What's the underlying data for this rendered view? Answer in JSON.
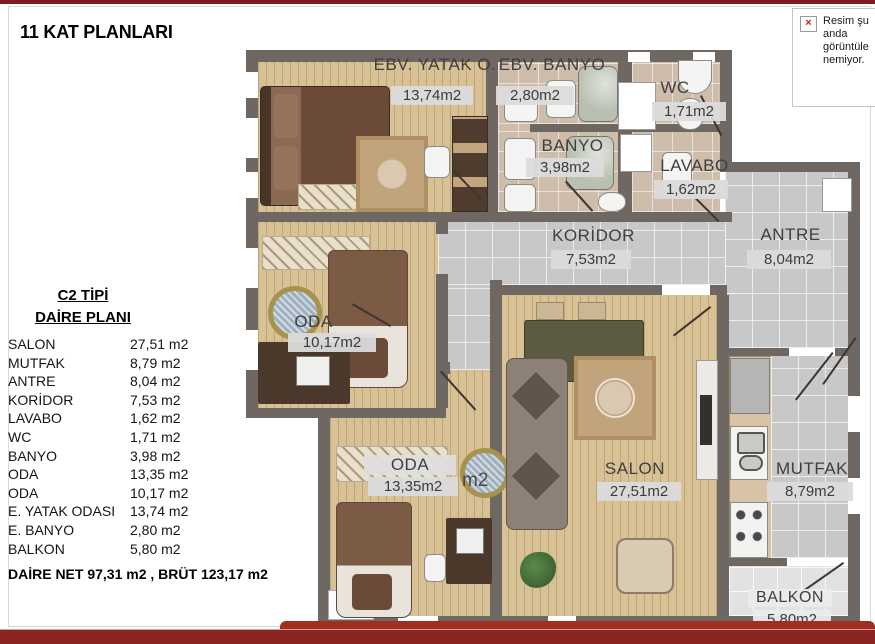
{
  "page": {
    "title": "11 KAT PLANLARI",
    "top_bar_color": "#7d1e1e",
    "bottom_bar_color": "#8b2521"
  },
  "broken_image_notice": {
    "icon": "broken-image-x-icon",
    "text": "Resim şu anda görüntüle nemiyor."
  },
  "legend": {
    "title_line1": "C2 TİPİ",
    "title_line2": "DAİRE PLANI",
    "items": [
      {
        "name": "SALON",
        "area": "27,51 m2"
      },
      {
        "name": "MUTFAK",
        "area": "8,79 m2"
      },
      {
        "name": "ANTRE",
        "area": "8,04 m2"
      },
      {
        "name": "KORİDOR",
        "area": "7,53 m2"
      },
      {
        "name": "LAVABO",
        "area": "1,62 m2"
      },
      {
        "name": "WC",
        "area": "1,71 m2"
      },
      {
        "name": "BANYO",
        "area": "3,98 m2"
      },
      {
        "name": "ODA",
        "area": "13,35 m2"
      },
      {
        "name": "ODA",
        "area": "10,17 m2"
      },
      {
        "name": "E. YATAK ODASI",
        "area": "13,74 m2"
      },
      {
        "name": "E. BANYO",
        "area": "2,80 m2"
      },
      {
        "name": "BALKON",
        "area": "5,80 m2"
      }
    ],
    "summary": "DAİRE NET 97,31 m2 , BRÜT 123,17 m2"
  },
  "plan": {
    "rooms": [
      {
        "name": "EBV. YATAK O.",
        "area": "13,74m2"
      },
      {
        "name": "EBV. BANYO",
        "area": "2,80m2"
      },
      {
        "name": "WC",
        "area": "1,71m2"
      },
      {
        "name": "BANYO",
        "area": "3,98m2"
      },
      {
        "name": "LAVABO",
        "area": "1,62m2"
      },
      {
        "name": "KORİDOR",
        "area": "7,53m2"
      },
      {
        "name": "ANTRE",
        "area": "8,04m2"
      },
      {
        "name": "ODA",
        "area": "10,17m2"
      },
      {
        "name": "ODA",
        "area": "13,35m2"
      },
      {
        "name": "SALON",
        "area": "27,51m2"
      },
      {
        "name": "MUTFAK",
        "area": "8,79m2"
      },
      {
        "name": "BALKON",
        "area": "5,80m2"
      }
    ],
    "stray_label": "m2",
    "colors": {
      "wall": "#6f6761",
      "wood_floor": "#d8c295",
      "tile_gray": "#c8c8c8",
      "tile_bath": "#cfbdac",
      "label_bg": "#dbdbdb"
    }
  }
}
